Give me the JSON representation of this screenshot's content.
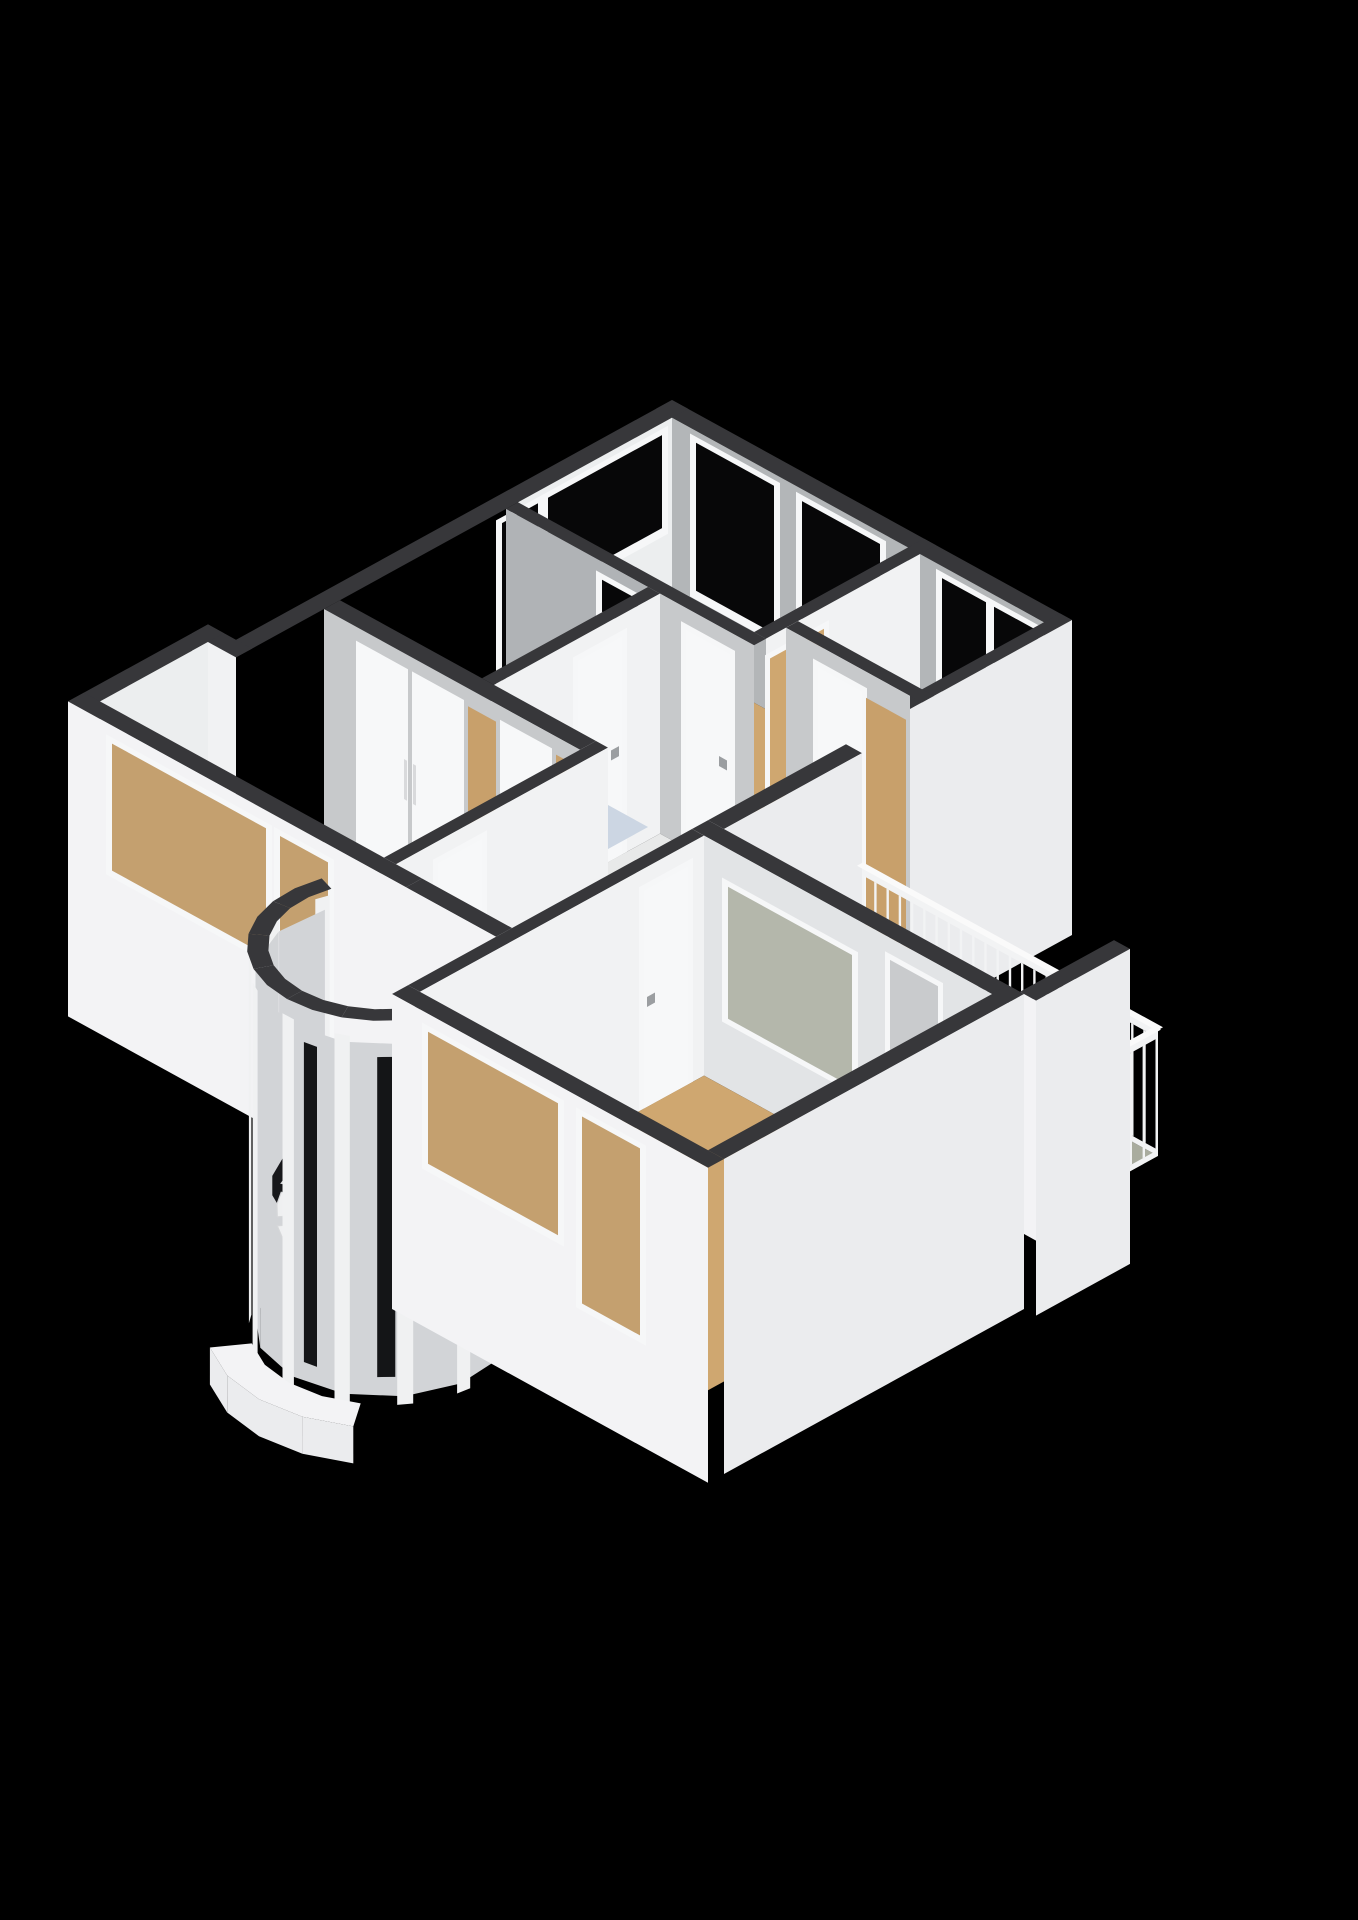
{
  "image_type": "3d-floorplan-render",
  "view": "isometric-cutaway-from-southwest",
  "colors": {
    "bg": "#000000",
    "cap": "#37373a",
    "ext-a": "#f3f3f5",
    "ext-b": "#ebecee",
    "int-light": "#eceeef",
    "int-bright": "#f1f2f3",
    "int-gray": "#b3b6b8",
    "int-gray2": "#c7c9cb",
    "bath-wall": "#b0b3b6",
    "lr-wall": "#e2e4e6",
    "wood": "#cfa770",
    "wood2": "#c8a06b",
    "hall-floor": "#e8e9e9",
    "bath-floor": "#ccd6e3",
    "shower-floor": "#c2cfdf",
    "balcony-floor": "#a9ac9e",
    "glass": "#070708",
    "sw-glass": "#c4a06f",
    "frame": "#f6f7f8",
    "balcony-glass": "#b4b7ab",
    "turret-glass": "#d2d4d7",
    "turret-slit": "#141517",
    "mullion": "#f0f1f2",
    "rail": "#f2f3f4",
    "rail-top": "#fafafa",
    "door": "#f7f8f9",
    "door-gray": "#c9cbcd",
    "door-edge": "#d9dadc",
    "handle": "#9b9ea1",
    "fixture-top": "#fafbfb",
    "fixture-inner": "#e9ebec",
    "fixture-face-a": "#f0f1f2",
    "fixture-face-b": "#e2e3e5",
    "stair": "#eff0f1",
    "stair-edge": "#d6d7d9",
    "stair-void": "#17181b",
    "shower-glass": "#cfdcea",
    "shower-column": "#a7abae"
  },
  "scene": {
    "rooms": [
      {
        "id": "bedroom-top",
        "floor": "wood",
        "features": [
          "window-ne-1",
          "window-ne-2",
          "window-nw-wide",
          "window-nw-narrow",
          "open-doorway"
        ]
      },
      {
        "id": "bedroom-right",
        "floor": "wood",
        "features": [
          "window-ne-1",
          "window-ne-2",
          "closet-doors"
        ]
      },
      {
        "id": "bathroom",
        "floor": "tile-blue",
        "features": [
          "bathtub",
          "vanity",
          "shower-enclosure",
          "small-window",
          "transom-window"
        ]
      },
      {
        "id": "hallway",
        "floor": "light",
        "features": [
          "interior-doors",
          "stair-opening"
        ]
      },
      {
        "id": "bedroom-left",
        "floor": "wood",
        "features": [
          "built-in-closet-doors",
          "window-sw-wide",
          "window-sw-narrow",
          "corner-nook"
        ]
      },
      {
        "id": "living-room",
        "floor": "wood",
        "features": [
          "balcony-window",
          "balcony-door",
          "window-sw-wide",
          "window-sw-tall"
        ]
      },
      {
        "id": "balcony",
        "floor": "concrete-green",
        "features": [
          "baluster-railing",
          "privacy-wall"
        ]
      },
      {
        "id": "stairwell-turret",
        "floor": "wood",
        "features": [
          "curved-glazing",
          "spiral-staircase",
          "entry-canopy"
        ]
      }
    ],
    "wall_style": "white-walls-dark-top-band",
    "background": "black"
  }
}
